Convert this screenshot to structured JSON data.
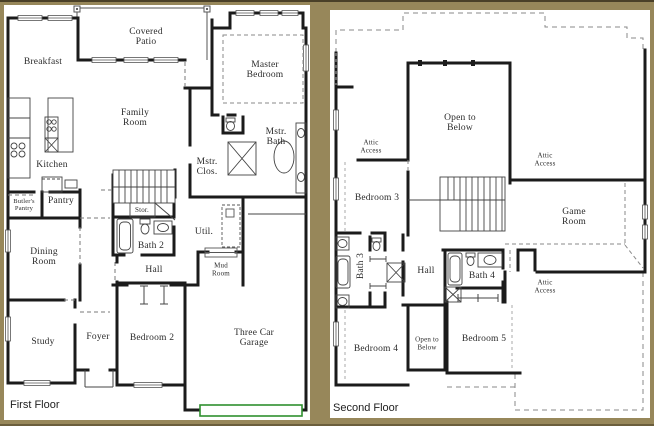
{
  "page": {
    "background_color": "#97875a",
    "panel_color": "#ffffff",
    "wall_color": "#1b1b1b",
    "garage_door_color": "#2f8f2f"
  },
  "first_floor": {
    "title": "First Floor",
    "rooms": {
      "breakfast": "Breakfast",
      "covered_patio": "Covered\nPatio",
      "family_room": "Family\nRoom",
      "master_bedroom": "Master\nBedroom",
      "mstr_bath": "Mstr.\nBath",
      "mstr_clos": "Mstr.\nClos.",
      "kitchen": "Kitchen",
      "butlers_pantry": "Butler's\nPantry",
      "pantry": "Pantry",
      "stor": "Stor.",
      "bath_2": "Bath 2",
      "util": "Util.",
      "hall": "Hall",
      "mud_room": "Mud\nRoom",
      "dining_room": "Dining\nRoom",
      "study": "Study",
      "foyer": "Foyer",
      "bedroom_2": "Bedroom 2",
      "garage": "Three Car Garage"
    }
  },
  "second_floor": {
    "title": "Second Floor",
    "rooms": {
      "attic_access_left": "Attic\nAccess",
      "open_to_below": "Open to\nBelow",
      "attic_access_right": "Attic\nAccess",
      "bedroom_3": "Bedroom 3",
      "game_room": "Game\nRoom",
      "bath_3": "Bath 3",
      "hall": "Hall",
      "bath_4": "Bath 4",
      "attic_access_bottom": "Attic\nAccess",
      "open_to_below_small": "Open to\nBelow",
      "bedroom_4": "Bedroom 4",
      "bedroom_5": "Bedroom 5"
    }
  }
}
